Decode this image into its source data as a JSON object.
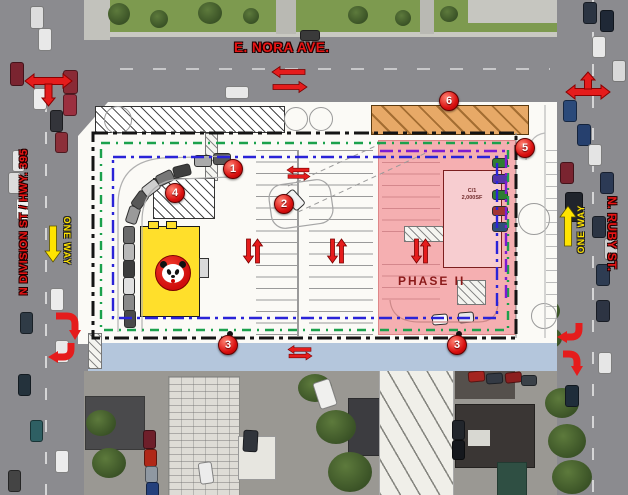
{
  "streets": {
    "nora_label": "E. NORA AVE.",
    "division_label": "N DIVISION ST / HWY. 395",
    "ruby_label": "N. RUBY ST.",
    "one_way_south_label": "ONE WAY",
    "one_way_north_label": "ONE WAY"
  },
  "plan": {
    "phase2_label": "PHASE II",
    "pad_building_label_line1": "C/1",
    "pad_building_label_line2": "2,000SF"
  },
  "markers": [
    {
      "num": "1"
    },
    {
      "num": "2"
    },
    {
      "num": "3"
    },
    {
      "num": "3"
    },
    {
      "num": "4"
    },
    {
      "num": "5"
    },
    {
      "num": "6"
    }
  ],
  "icons": {
    "intersection_arrow_nw": "three-way-arrow-left-right-down",
    "intersection_arrow_ne": "three-way-arrow-left-right-up",
    "one_way_arrow_south": "down-arrow",
    "one_way_arrow_north": "up-arrow",
    "aisle_arrows": "paired-up-down-arrows",
    "street_flow_arrows": "paired-left-right-arrows",
    "turn_arrows": "curved-turn-arrow",
    "brand_logo": "panda-logo"
  },
  "colors": {
    "marker_red": "#d90f0f",
    "street_label_red": "#e81515",
    "one_way_yellow": "#ffe400",
    "phase2_pink": "#f49ca0",
    "phase2_text": "#8b1a1a",
    "building_yellow": "#ffdf2b",
    "loading_zone_orange": "#e7a967",
    "alley_blue": "#b4c6dc",
    "boundary_black": "#141414",
    "boundary_green": "#1ba14c",
    "boundary_blue": "#2a23d8",
    "boundary_purple": "#7d1bd1"
  }
}
